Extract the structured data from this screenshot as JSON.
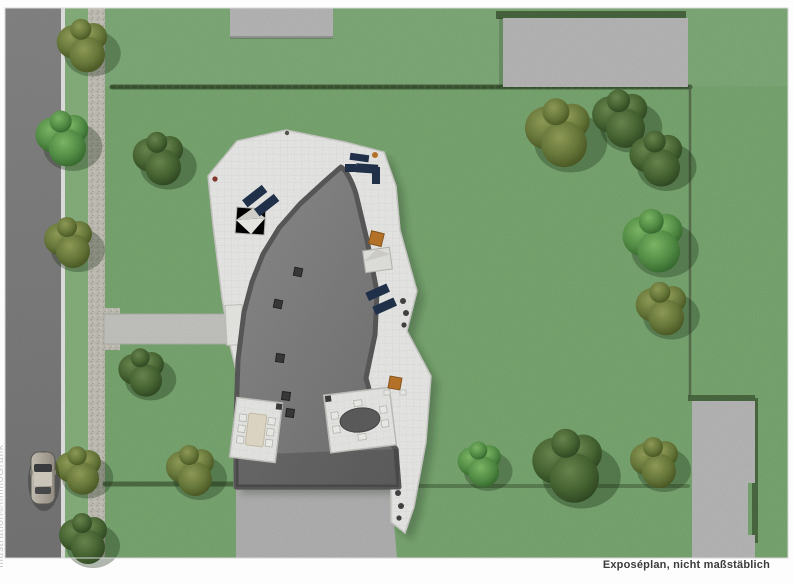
{
  "captions": {
    "credit": "Illustration©ImmoGrafik",
    "disclaimer": "Exposéplan, nicht maßstäblich"
  },
  "colors": {
    "paper": "#fdfdfd",
    "lawn": "#7cab74",
    "lawn_verge": "#8ab580",
    "road": "#7e7e7e",
    "road_line": "#e9e9e9",
    "sidewalk": "#c7c5bb",
    "garden_path": "#c9c9c5",
    "hedge": "#44603a",
    "fence": "#56684a",
    "neighbor_building": "#bcbcbc",
    "driveway": "#b6b6b6",
    "roof": "#828282",
    "roof_edge": "#5c5c5c",
    "terrace": "#f1f1ef",
    "dining_table_cream": "#e9e2cf",
    "dining_table_dark": "#606060",
    "furniture_navy": "#22344e",
    "furniture_wood": "#c07a2c",
    "tree_dark": "#3f5e2f",
    "tree_olive": "#6d7f3e",
    "tree_bright": "#58964a",
    "car_body": "#beb8ac",
    "footer_text": "#3b3b3b",
    "credit_text": "#c8c8c8"
  }
}
